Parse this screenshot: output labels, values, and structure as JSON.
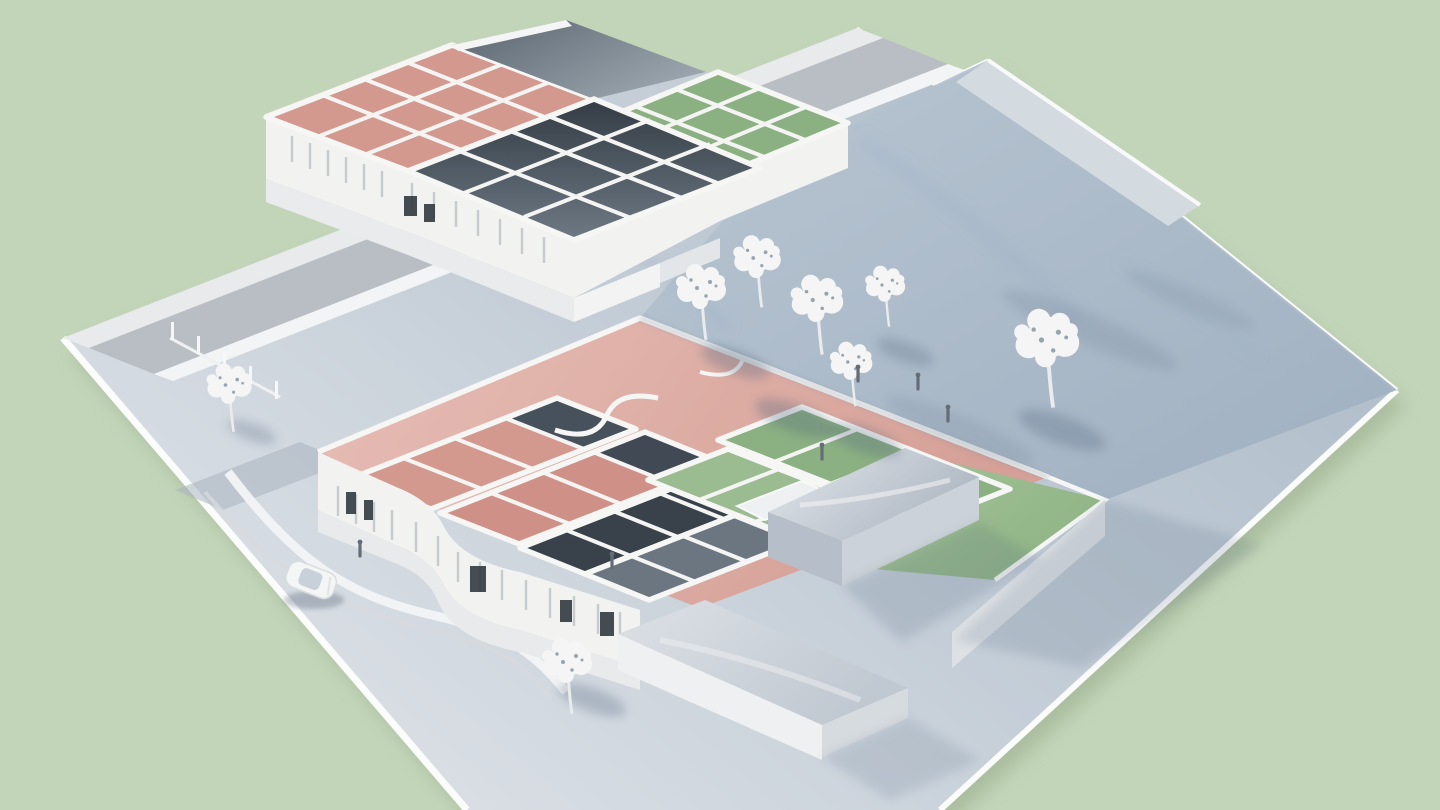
{
  "meta": {
    "title": "Architectural massing model with cutaway floor plans",
    "description": "White architectural scale model on a pale blue-grey base plate over a sage green background. Two cutaway buildings reveal floor plans with rose-pink and sage-green room zones and dark service rooms, surrounded by white model trees, tiny figures and a single white car on the street."
  },
  "palette": {
    "background": "#c3d5b9",
    "ground_shadow": "#9db08f",
    "plate_light": "#dfe3e8",
    "plate_mid": "#c2ccd6",
    "plate_dark": "#a9b8c6",
    "sidewalk": "#e8eaec",
    "street": "#b9bec5",
    "curb": "#f3f4f5",
    "wall_white": "#f2f3f1",
    "plinth": "#e8eaec",
    "courtyard_light": "#b9c6d3",
    "courtyard_dark": "#9fb0c1",
    "pink_plane_light": "#e7beb6",
    "pink_plane": "#d5a097",
    "pink_floor": "#d3988e",
    "pink_floor_deep": "#cf9187",
    "green_plane_light": "#b7d0ac",
    "green_plane": "#93b788",
    "green_floor": "#8bb082",
    "green_floor_light": "#9bbb90",
    "dark_room": "#39424b",
    "dark_room_mid": "#6b7681",
    "roof_slab_dark": "#5a646e",
    "roof_slab_light": "#9aa4ad",
    "metal_light": "#e3e7ec",
    "metal_dark": "#aeb7c2",
    "window_dark": "#2e353b",
    "tree": "#f4f5f4",
    "tree_speck": "#97a4b0",
    "trunk": "#e9ebec",
    "figure": "#646d77",
    "car_body": "#f4f5f5",
    "car_glass": "#c5ced7",
    "shadow": "#4f647c"
  },
  "scene": {
    "base_plate": {
      "label": "site base plate"
    },
    "upper_building": {
      "label": "rear building cutaway model",
      "sections": [
        {
          "name": "pink-room-zone"
        },
        {
          "name": "grey-service-rooms"
        },
        {
          "name": "green-room-zone"
        },
        {
          "name": "dark-roof-slab"
        }
      ]
    },
    "lower_building": {
      "label": "front building cutaway model",
      "sections": [
        {
          "name": "pink-roof-plane"
        },
        {
          "name": "pink-room-zone"
        },
        {
          "name": "dark-service-rooms"
        },
        {
          "name": "green-room-zone"
        }
      ]
    },
    "out_buildings": {
      "count": 2,
      "label": "solid massing blocks"
    },
    "trees": {
      "count": 8
    },
    "figures": {
      "count": 6
    },
    "vehicles": {
      "count": 1,
      "label": "white car"
    }
  }
}
